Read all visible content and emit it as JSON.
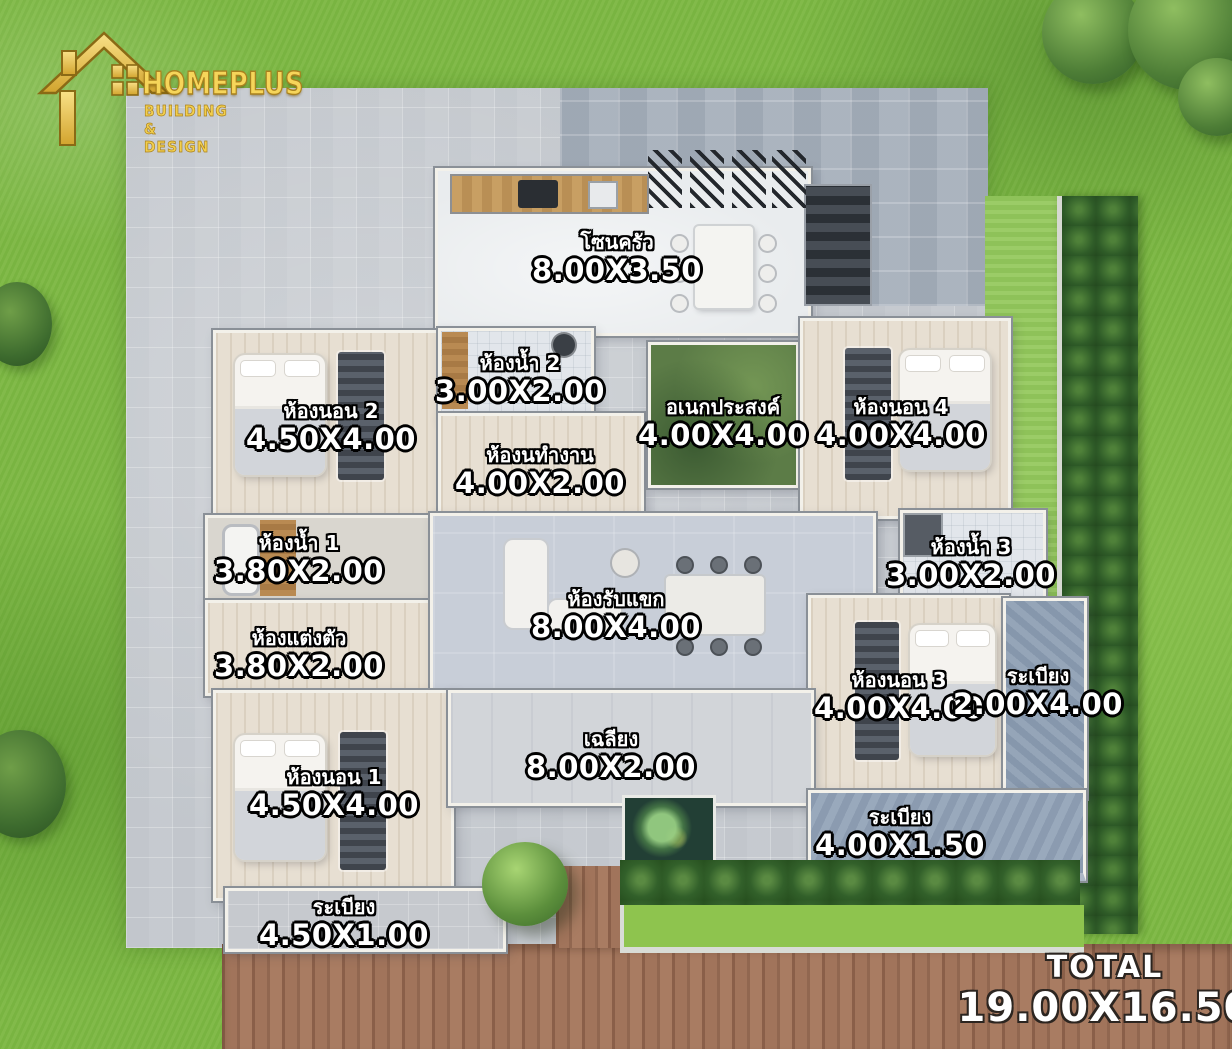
{
  "logo": {
    "brand": "HOMEPLUS",
    "tagline": "BUILDING & DESIGN",
    "icon": "gold-house-icon",
    "color": "#f2c94c"
  },
  "total": {
    "label": "TOTAL",
    "dims": "19.00X16.50"
  },
  "rooms": {
    "kitchen": {
      "name": "โซนครัว",
      "dims": "8.00X3.50"
    },
    "bath2": {
      "name": "ห้องน้ำ 2",
      "dims": "3.00X2.00"
    },
    "bed2": {
      "name": "ห้องนอน 2",
      "dims": "4.50X4.00"
    },
    "multipurpose": {
      "name": "อเนกประสงค์",
      "dims": "4.00X4.00"
    },
    "bed4": {
      "name": "ห้องนอน 4",
      "dims": "4.00X4.00"
    },
    "office": {
      "name": "ห้องนทำงาน",
      "dims": "4.00X2.00"
    },
    "bath1": {
      "name": "ห้องน้ำ 1",
      "dims": "3.80X2.00"
    },
    "bath3": {
      "name": "ห้องน้ำ 3",
      "dims": "3.00X2.00"
    },
    "living": {
      "name": "ห้องรับแขก",
      "dims": "8.00X4.00"
    },
    "dressing": {
      "name": "ห้องแต่งตัว",
      "dims": "3.80X2.00"
    },
    "bed3": {
      "name": "ห้องนอน 3",
      "dims": "4.00X4.00"
    },
    "balcony_east": {
      "name": "ระเบียง",
      "dims": "2.00X4.00"
    },
    "bed1": {
      "name": "ห้องนอน 1",
      "dims": "4.50X4.00"
    },
    "porch": {
      "name": "เฉลียง",
      "dims": "8.00X2.00"
    },
    "balcony_southeast": {
      "name": "ระเบียง",
      "dims": "4.00X1.50"
    },
    "balcony_southwest": {
      "name": "ระเบียง",
      "dims": "4.50X1.00"
    }
  },
  "colors": {
    "grass": "#7db843",
    "pavement": "#c9cdd2",
    "deck_wood": "#9a6e55",
    "hedge": "#2f5c28",
    "label_text": "#ffffff",
    "label_outline": "#000000",
    "logo_gold": "#f2c94c"
  }
}
